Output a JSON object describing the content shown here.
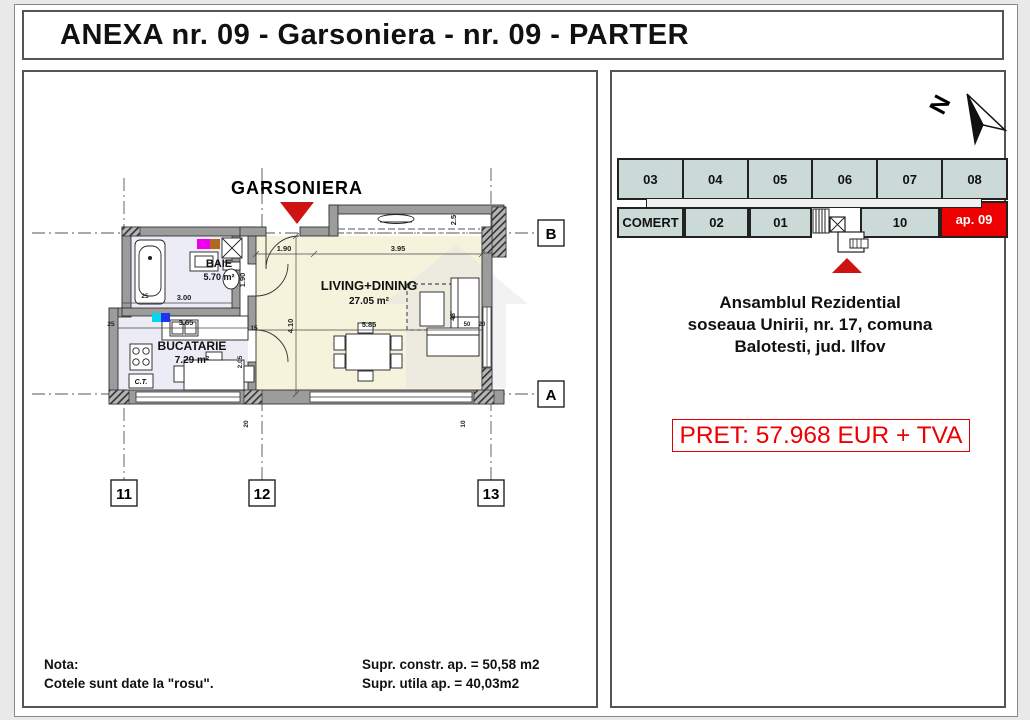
{
  "title": "ANEXA nr. 09 - Garsoniera - nr. 09 - PARTER",
  "plan": {
    "label": "GARSONIERA",
    "rooms": {
      "baie": {
        "name": "BAIE",
        "area": "5.70 m²"
      },
      "bucatarie": {
        "name": "BUCATARIE",
        "area": "7.29 m²"
      },
      "living": {
        "name": "LIVING+DINING",
        "area": "27.05 m²"
      }
    },
    "fixtures": {
      "ct": "C.T."
    },
    "grid": {
      "row_b": "B",
      "row_a": "A",
      "col_11": "11",
      "col_12": "12",
      "col_13": "13"
    },
    "dims": {
      "living_top_a": "1.90",
      "living_top_b": "3.95",
      "living_left": "4.10",
      "living_mid": "5.85",
      "alcove": "2.5",
      "bath_w": "3.00",
      "bath_door": "1.90",
      "kitchen_w": "3.65",
      "d15": "15",
      "d25a": "25",
      "d25b": "25",
      "d205": "2.05",
      "d50": "50",
      "d20": "20",
      "d20b": "20",
      "d10": "10",
      "tv": "48'"
    }
  },
  "site": {
    "north": "N",
    "units_top": [
      "03",
      "04",
      "05",
      "06",
      "07",
      "08"
    ],
    "units_bottom": [
      "COMERT",
      "02",
      "01",
      "10"
    ],
    "highlight": "ap. 09"
  },
  "address": {
    "line1": "Ansamblul Rezidential",
    "line2": "soseaua Unirii, nr. 17, comuna",
    "line3": "Balotesti, jud. Ilfov"
  },
  "price": "PRET: 57.968 EUR + TVA",
  "notes": {
    "label": "Nota:",
    "text": "Cotele sunt date la \"rosu\"."
  },
  "areas": {
    "constr": "Supr. constr. ap. = 50,58 m2",
    "utila": "Supr. utila ap. = 40,03m2"
  },
  "colors": {
    "accent_red": "#ee0000",
    "triangle_red": "#cf1212",
    "unit_fill": "#cbdad7",
    "living_floor": "#f6f3dd",
    "wet_floor": "#ebecf5",
    "wall_gray": "#9c9c9c"
  }
}
